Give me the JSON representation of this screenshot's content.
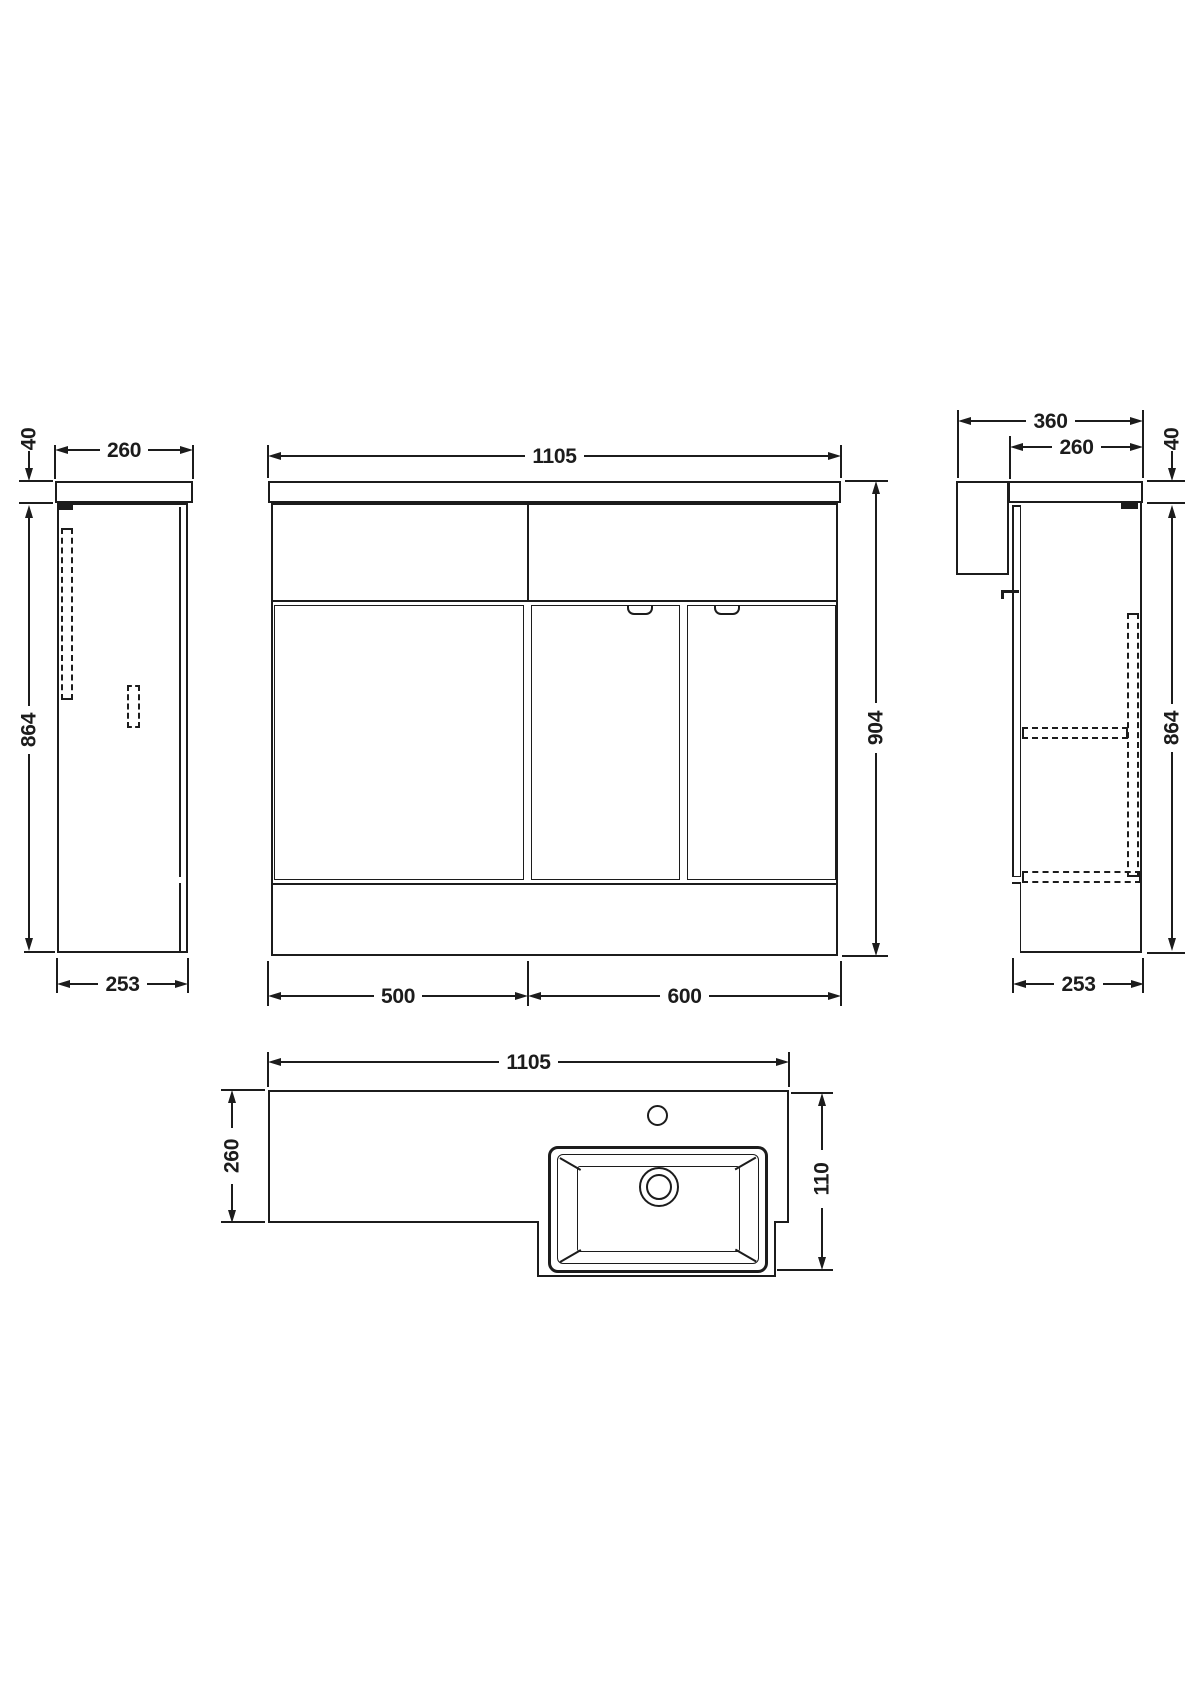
{
  "drawing": {
    "background": "#ffffff",
    "line_color": "#1c1c1c",
    "description": "Orthographic technical drawing of combination vanity basin unit with four views",
    "views": {
      "left_side": {
        "label": "left side elevation",
        "dims": {
          "depth_top": "260",
          "worktop_thickness": "40",
          "cabinet_height": "864",
          "depth_base": "253"
        }
      },
      "front": {
        "label": "front elevation",
        "dims": {
          "width_total": "1105",
          "height_total": "904",
          "width_left_unit": "500",
          "width_right_unit": "600"
        }
      },
      "right_side": {
        "label": "right side elevation",
        "dims": {
          "depth_total": "360",
          "depth_worktop": "260",
          "worktop_thickness": "40",
          "cabinet_height": "864",
          "depth_base": "253"
        }
      },
      "plan": {
        "label": "plan view",
        "dims": {
          "width_total": "1105",
          "depth_worktop": "260",
          "basin_projection": "110"
        }
      }
    }
  }
}
